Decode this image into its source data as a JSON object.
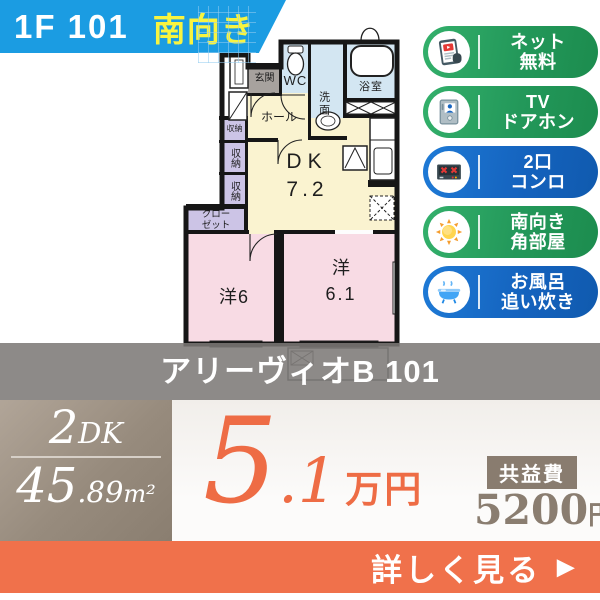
{
  "header": {
    "floor_unit": "1F 101",
    "facing": "南向き"
  },
  "floorplan": {
    "rooms": {
      "genkan": "玄関",
      "wc": "WC",
      "washroom": "洗面",
      "bathroom": "浴室",
      "hall": "ホール",
      "storage_1": "収納",
      "storage_2": "収納",
      "storage_3": "収納",
      "closet_line1": "クロー",
      "closet_line2": "ゼット",
      "dk_name": "DK",
      "dk_area": "7.2",
      "bedroom1": "洋6",
      "bedroom2_name": "洋",
      "bedroom2_area": "6.1"
    }
  },
  "badges": [
    {
      "id": "net-free",
      "line1": "ネット",
      "line2": "無料",
      "color": "#23985a",
      "icon": "internet-tablet-icon"
    },
    {
      "id": "tv-doorphone",
      "line1": "TV",
      "line2": "ドアホン",
      "color": "#23985a",
      "icon": "doorphone-icon"
    },
    {
      "id": "two-burner-stove",
      "line1": "2口",
      "line2": "コンロ",
      "color": "#1462bd",
      "icon": "stove-icon"
    },
    {
      "id": "south-corner",
      "line1": "南向き",
      "line2": "角部屋",
      "color": "#23985a",
      "icon": "sun-icon"
    },
    {
      "id": "bath-reheat",
      "line1": "お風呂",
      "line2": "追い炊き",
      "color": "#1462bd",
      "icon": "bathtub-icon"
    }
  ],
  "title_bar": {
    "name": "アリーヴィオB 101"
  },
  "plan": {
    "type_num": "2",
    "type_suffix": "DK",
    "area_int": "45",
    "area_dec": ".89",
    "area_unit": "m²"
  },
  "price": {
    "int": "5",
    "dec": ".1",
    "unit": "万円"
  },
  "fee": {
    "label": "共益費",
    "amount": "5200",
    "unit": "円"
  },
  "footer": {
    "cta": "詳しく見る",
    "arrow": "▶"
  },
  "colors": {
    "banner_blue": "#1b9ce2",
    "highlight_yellow": "#f8f440",
    "badge_green": "#23985a",
    "badge_blue": "#1462bd",
    "accent_orange": "#f0714b",
    "plan_box_taupe": "#948878",
    "fee_brown": "#8a7d70",
    "room_water_blue": "#d3e6f2",
    "room_cream": "#faf3d0",
    "room_pink": "#f8dbe4",
    "room_lavender": "#ccc4e6"
  }
}
